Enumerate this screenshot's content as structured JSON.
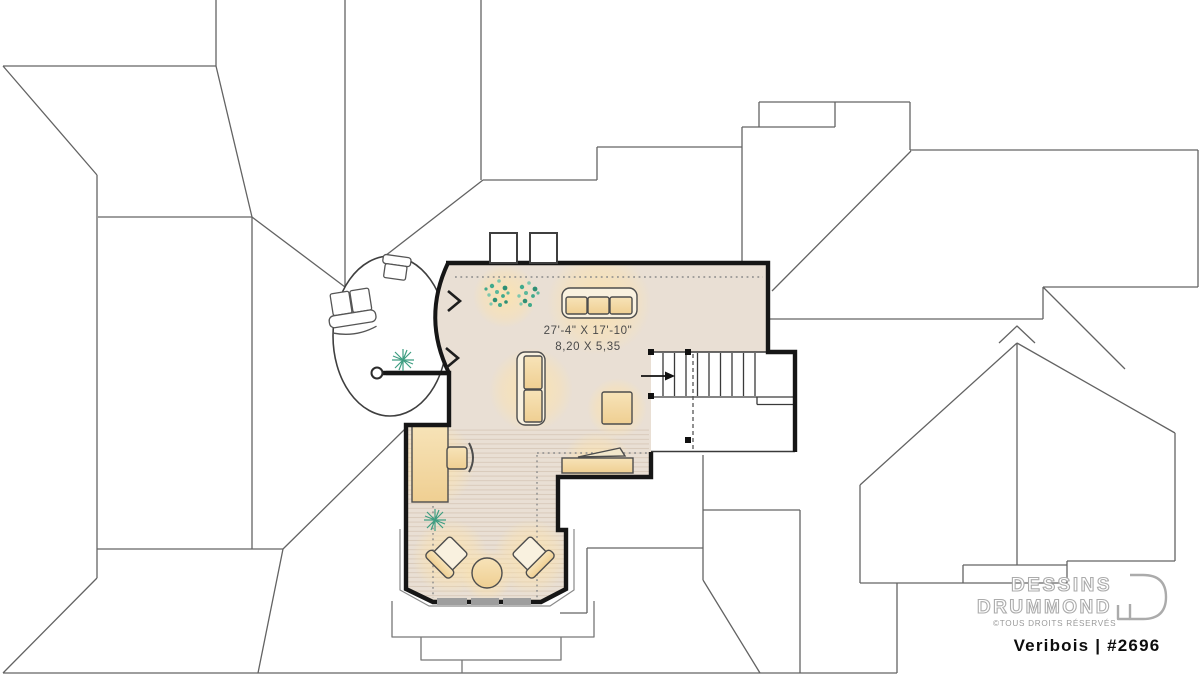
{
  "floor_plan": {
    "bonus_room": {
      "dimension_imperial": "27'-4\" X 17'-10\"",
      "dimension_metric": "8,20 X 5,35"
    }
  },
  "branding": {
    "studio_line1": "DESSINS",
    "studio_line2": "DRUMMOND",
    "copyright": "©TOUS DROITS RÉSERVÉS",
    "plan_label": "Veribois  | #2696"
  },
  "colors": {
    "floor_fill": "#E9DFD4",
    "floor_hatch": "#D5C6B6",
    "furniture_tan": "#F3D9A4",
    "furniture_cream": "#F9F1DF",
    "glow_warm": "#FFE3A8",
    "plant_green": "#3FA98C",
    "wall_black": "#161616",
    "roof_line_gray": "#636363",
    "logo_gray": "#ABABAB",
    "window_gray": "#9E9E9E"
  }
}
